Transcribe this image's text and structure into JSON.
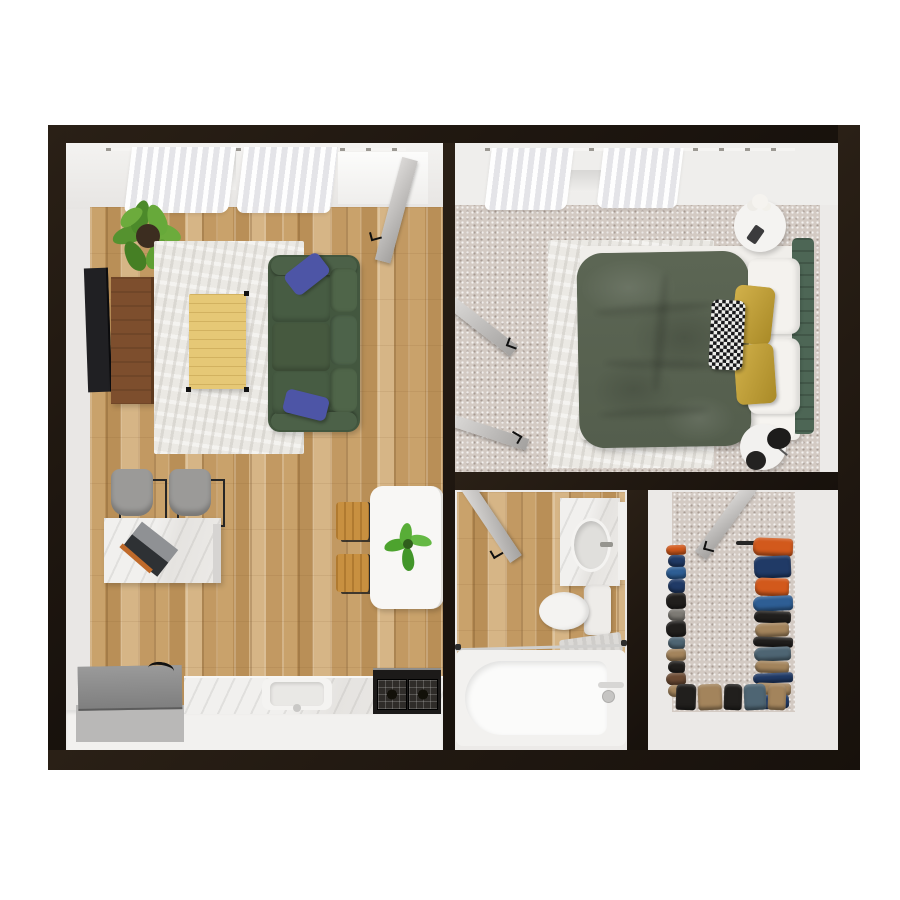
{
  "scene": {
    "title": "apartment-3d-floor-plan-top-view",
    "background": "#ffffff",
    "rooms": [
      "living-room-kitchen",
      "bedroom",
      "bathroom",
      "closet"
    ]
  },
  "palette": {
    "wall": "#1f1710",
    "wood": "#c9a26b",
    "carpet": "#d3cac3",
    "rug": "#ebe9e4",
    "inner_face": "#eceae8",
    "sofa": "#43573f",
    "sofa_cushion": "#4a5f46",
    "pillow_blue": "#4d55a6",
    "duvet": "#5c6654",
    "headboard": "#4d6655",
    "pillow_gold": "#c2a037",
    "pillow_white": "#f4f2ee",
    "coffee_table": "#e6c876",
    "console": "#7d4e2d",
    "tv": "#202023",
    "chair": "#9b9a98",
    "desk": "#eceae8",
    "laptop": "#2e3134",
    "island": "#f8f7f5",
    "stool": "#c89040",
    "counter": "#e8e6e3",
    "cabinet": "#f2f1ef",
    "stove": "#1c1a19",
    "washer": "#8c8c8c",
    "fixture_white": "#f2f1ef",
    "vanity": "#e9e7e4",
    "door": "#c0bebc",
    "plant": "#55922f",
    "plant_light": "#6cab3c",
    "pot": "#3c2d20",
    "flowers": "#f5f3ef",
    "clothes": {
      "orange": "#d2591c",
      "blue": "#2e5e94",
      "navy": "#203a66",
      "black": "#211f1d",
      "tan": "#a3845c",
      "brown": "#6b4a33",
      "slate": "#4e6573",
      "gray": "#7d7a74"
    }
  },
  "furniture": {
    "living_room_kitchen": [
      "potted-plant",
      "tv",
      "tv-console",
      "area-rug",
      "coffee-table",
      "sofa",
      "throw-pillows",
      "desk",
      "laptop",
      "desk-chairs",
      "kitchen-island",
      "bar-stools",
      "island-plant",
      "washer",
      "kitchen-counter",
      "sink",
      "stove",
      "entry-door"
    ],
    "bedroom": [
      "curtains",
      "double-bed",
      "duvet",
      "pillows",
      "headboard",
      "area-rug",
      "round-nightstand",
      "flower-vase",
      "phone",
      "round-side-table",
      "speakers",
      "double-doors"
    ],
    "bathroom": [
      "vanity",
      "sink",
      "faucet",
      "toilet",
      "bathtub",
      "tub-faucet",
      "bath-mat",
      "shower-rod",
      "door"
    ],
    "closet": [
      "clothes-rail-right",
      "clothes-rail-left",
      "clothes-rail-bottom",
      "hanging-clothes",
      "door"
    ]
  },
  "closet": {
    "right_rail": [
      {
        "c": "orange",
        "h": 18
      },
      {
        "c": "navy",
        "h": 22
      },
      {
        "c": "orange",
        "h": 18
      },
      {
        "c": "blue",
        "h": 15
      },
      {
        "c": "black",
        "h": 12
      },
      {
        "c": "tan",
        "h": 14
      },
      {
        "c": "black",
        "h": 10
      },
      {
        "c": "slate",
        "h": 14
      },
      {
        "c": "tan",
        "h": 12
      },
      {
        "c": "navy",
        "h": 10
      },
      {
        "c": "tan",
        "h": 12
      },
      {
        "c": "navy",
        "h": 14
      }
    ],
    "left_rail": [
      {
        "c": "orange",
        "h": 10
      },
      {
        "c": "navy",
        "h": 12
      },
      {
        "c": "blue",
        "h": 12
      },
      {
        "c": "navy",
        "h": 14
      },
      {
        "c": "black",
        "h": 16
      },
      {
        "c": "gray",
        "h": 12
      },
      {
        "c": "black",
        "h": 16
      },
      {
        "c": "slate",
        "h": 12
      },
      {
        "c": "tan",
        "h": 12
      },
      {
        "c": "black",
        "h": 12
      },
      {
        "c": "brown",
        "h": 12
      },
      {
        "c": "tan",
        "h": 12
      }
    ],
    "bottom_rail": [
      {
        "c": "black",
        "w": 20
      },
      {
        "c": "tan",
        "w": 24
      },
      {
        "c": "black",
        "w": 18
      },
      {
        "c": "slate",
        "w": 22
      },
      {
        "c": "tan",
        "w": 18
      }
    ]
  }
}
